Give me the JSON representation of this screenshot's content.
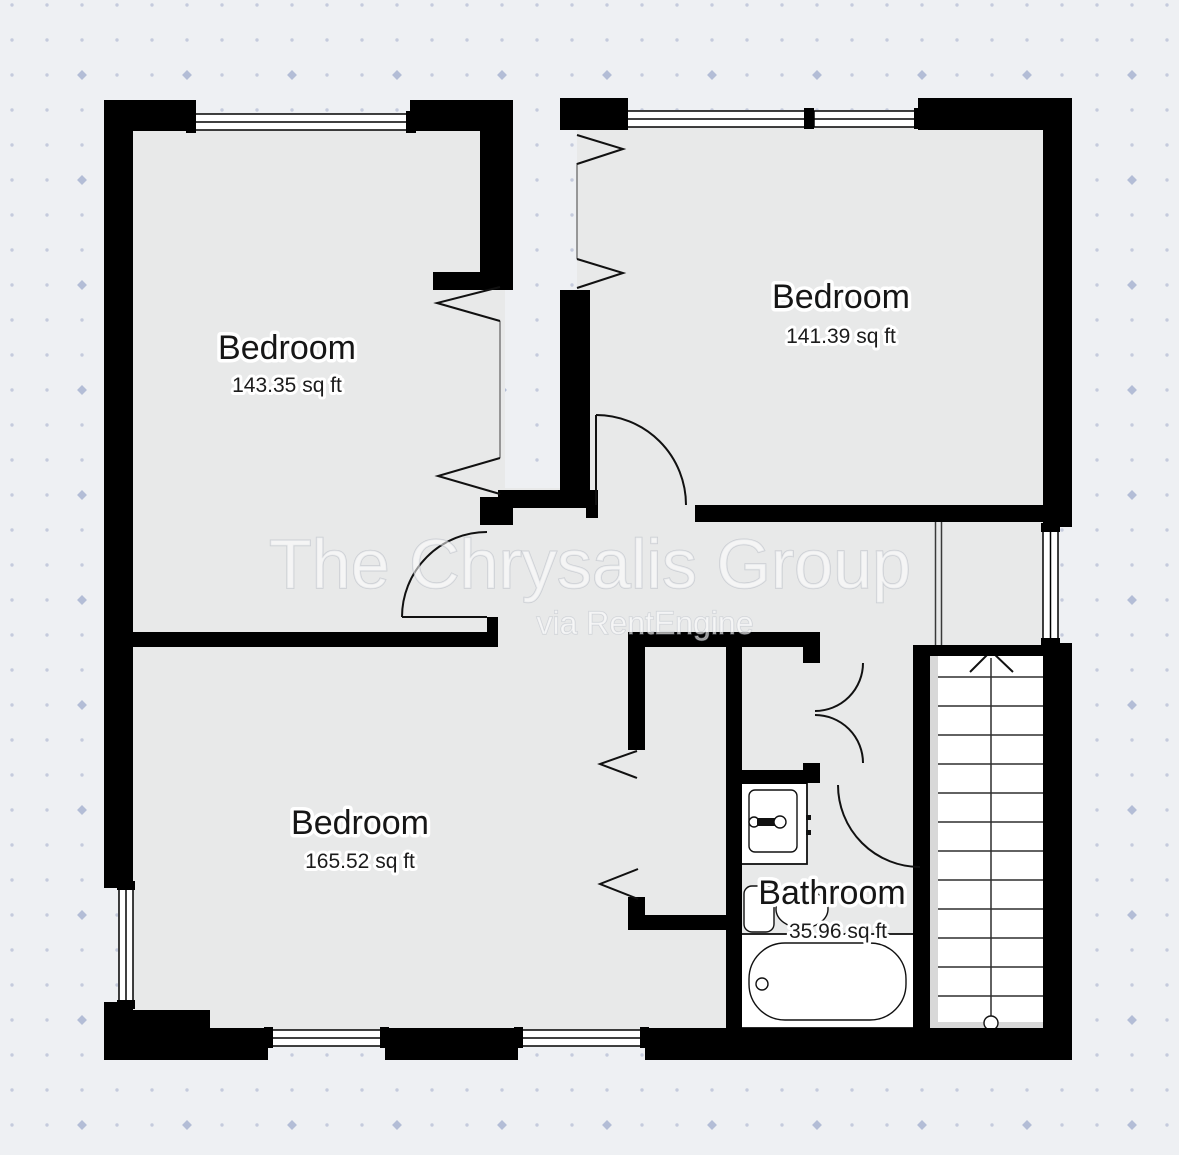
{
  "floorplan": {
    "rooms": [
      {
        "name": "Bedroom",
        "area": "143.35 sq ft"
      },
      {
        "name": "Bedroom",
        "area": "141.39 sq ft"
      },
      {
        "name": "Bedroom",
        "area": "165.52 sq ft"
      },
      {
        "name": "Bathroom",
        "area": "35.96 sq ft"
      }
    ],
    "watermark": {
      "primary": "The Chrysalis Group",
      "secondary": "via RentEngine"
    },
    "colors": {
      "wall": "#000000",
      "floor": "#e8e9e9",
      "background": "#eef0f3",
      "dot_small": "#c5cbdd",
      "dot_large": "#b3bdd6"
    }
  }
}
